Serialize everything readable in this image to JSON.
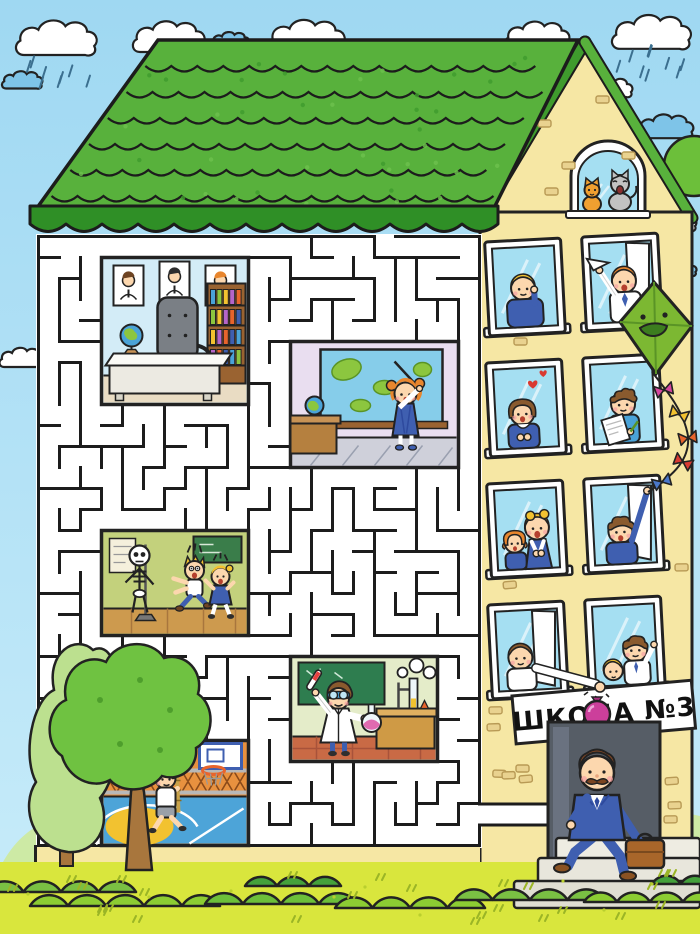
{
  "sign": {
    "text": "ШКОЛА №3"
  },
  "scene": {
    "setting": "Cartoon school building; the left wing is a maze puzzle, the right wing shows windows with children",
    "weather": [
      "white clouds",
      "small blue clouds",
      "rain showers"
    ],
    "attic": "orange cat and grey meowing cat in arched attic window",
    "kite": "green smiling kite with a tail of coloured bows held by a boy in a window",
    "balloon": "pink water balloon dropped from a fourth-floor window",
    "director": "man with moustache in a blue suit carrying a briefcase climbing the entrance steps",
    "maze_rooms": [
      {
        "name": "principal-office",
        "description": "office with three portraits, bookshelf, desk, chair and globe"
      },
      {
        "name": "geography-class",
        "description": "girl with a pointer at a world map, desk with globe"
      },
      {
        "name": "anatomy-class",
        "description": "skeleton scaring a boy and a girl"
      },
      {
        "name": "chemistry-lab",
        "description": "young chemist in goggles holding a test tube and a flask"
      },
      {
        "name": "gym",
        "description": "kid climbing a rope, basketball hoop and court"
      }
    ],
    "windows": [
      {
        "position": "row1-left",
        "occupants": "blonde boy in blue sweater"
      },
      {
        "position": "row1-right",
        "occupants": "red-haired boy throwing a paper airplane"
      },
      {
        "position": "row2-left",
        "occupants": "girl with brown bob and hearts"
      },
      {
        "position": "row2-right",
        "occupants": "curly-haired boy with book and pencil"
      },
      {
        "position": "row3-left",
        "occupants": "two girls singing"
      },
      {
        "position": "row3-right",
        "occupants": "boy holding the kite string"
      },
      {
        "position": "row4-left",
        "occupants": "boy dropping the pink water balloon"
      },
      {
        "position": "row4-right",
        "occupants": "two boys"
      }
    ]
  },
  "palette": {
    "sky": "#a6ddf3",
    "roof": "#58b13c",
    "roof_dark": "#2f8f26",
    "wall": "#f6e7a4",
    "maze_line": "#1c1c1c",
    "grass": "#d9e63d",
    "bush": "#7ac043",
    "door": "#565d66",
    "kite": "#7cb832",
    "balloon": "#cc3f9b",
    "suit": "#3f5fb0",
    "window_glass": "#a5dff2"
  }
}
